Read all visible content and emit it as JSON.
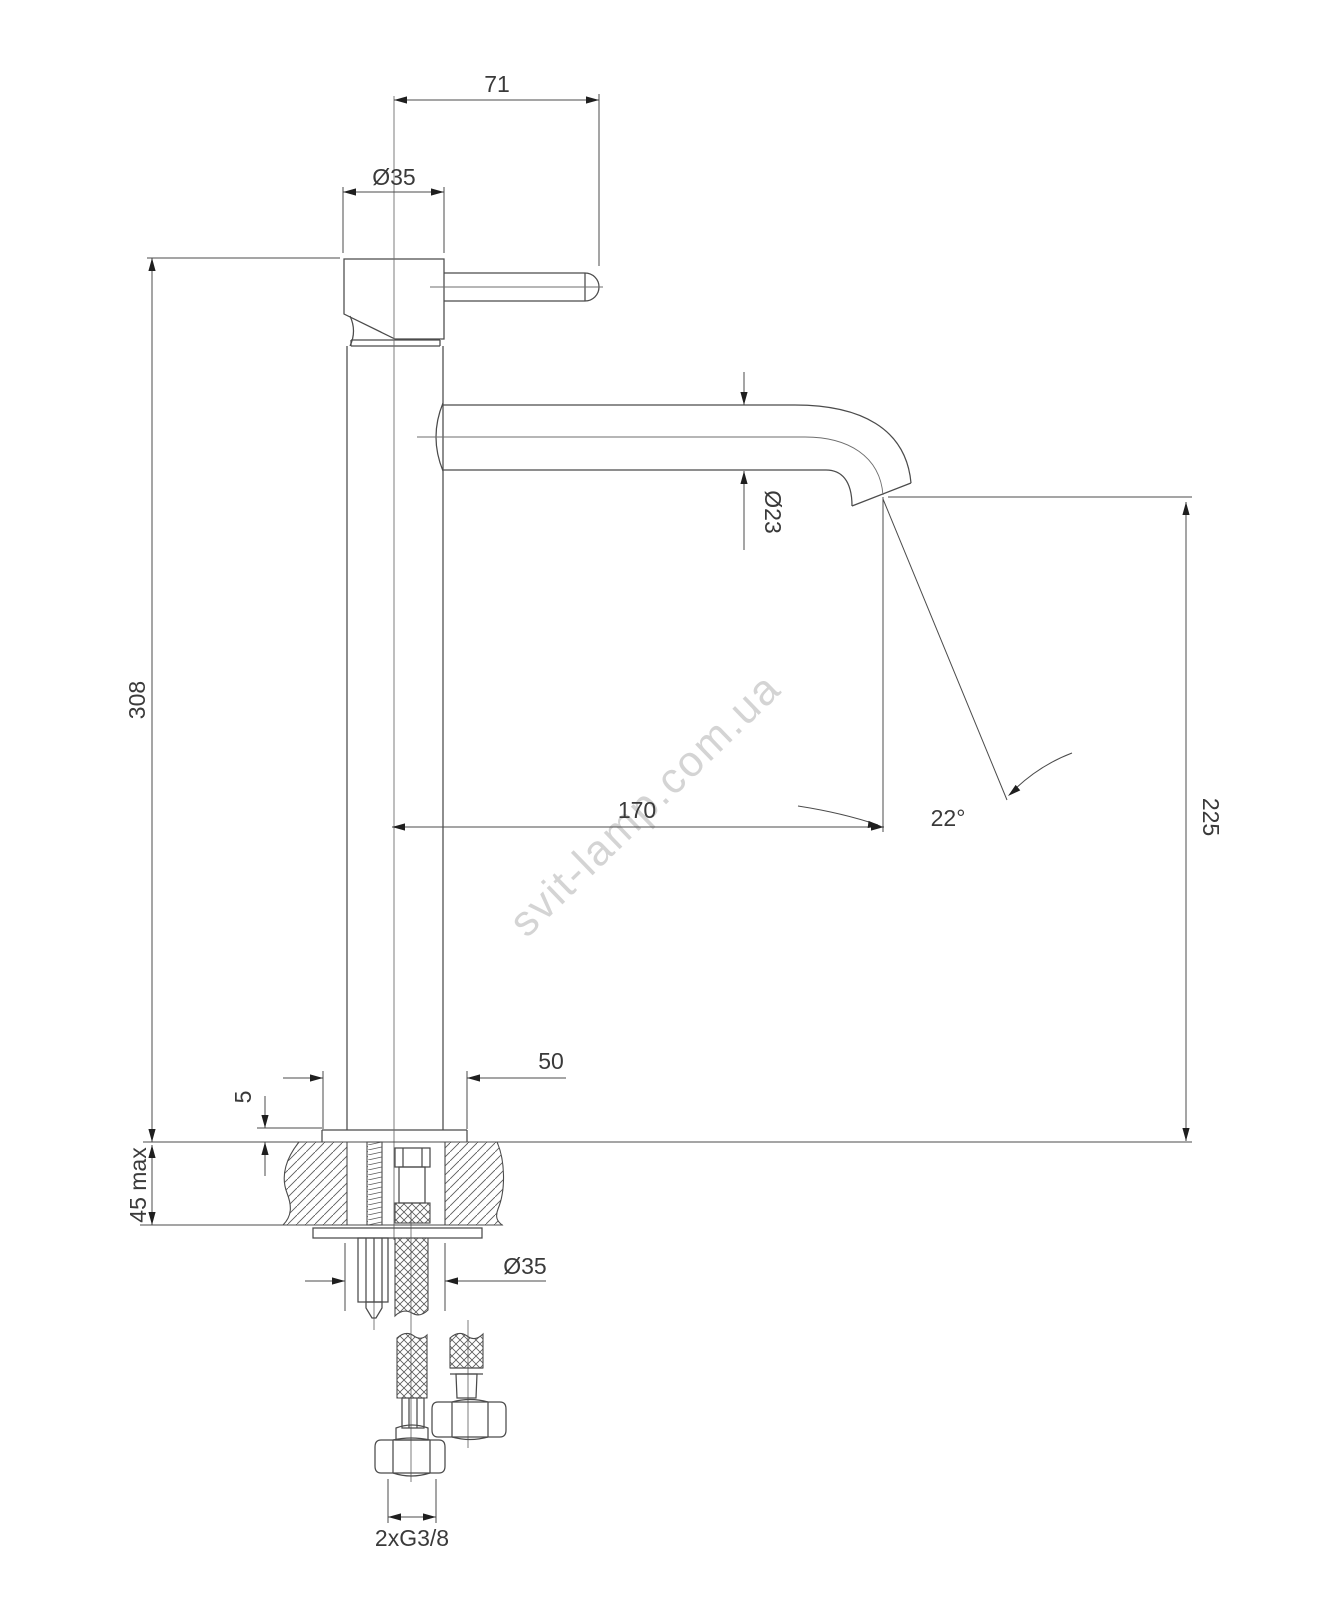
{
  "drawing": {
    "type": "faucet-installation-technical-drawing",
    "watermark": "svit-lamp.com.ua",
    "line_color": "#4b4b4b",
    "text_color": "#3a3a3a",
    "dims": {
      "handle_length": "71",
      "body_diameter": "Ø35",
      "total_height": "308",
      "spout_tube_diameter": "Ø23",
      "spout_reach": "170",
      "spout_angle": "22°",
      "spout_outlet_height": "225",
      "base_width": "50",
      "base_plate_thickness": "5",
      "deck_thickness_max": "45 max",
      "shank_diameter": "Ø35",
      "hose_connection": "2xG3/8"
    }
  }
}
